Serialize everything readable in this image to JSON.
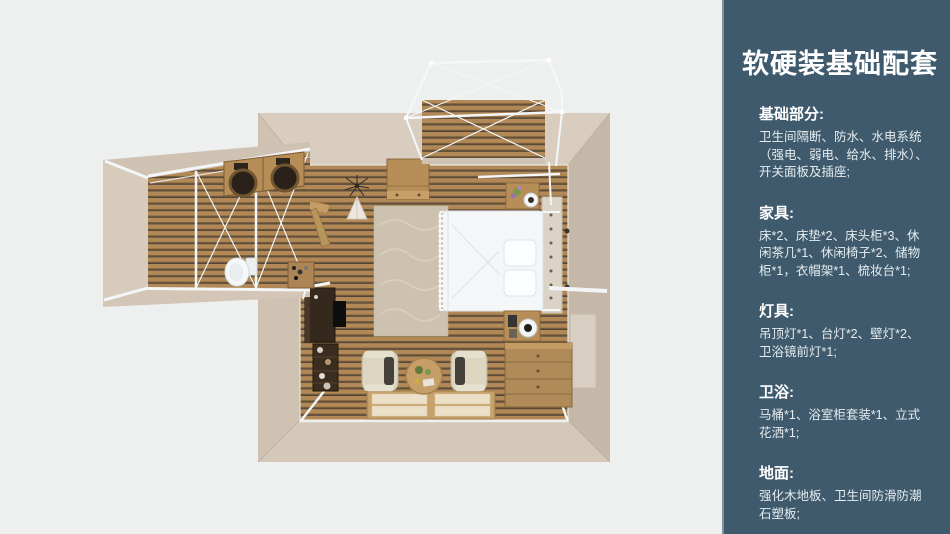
{
  "panel": {
    "title": "软硬装基础配套",
    "sections": [
      {
        "heading": "基础部分:",
        "body": "卫生间隔断、防水、水电系统\n（强电、弱电、给水、排水）、\n开关面板及插座;"
      },
      {
        "heading": "家具:",
        "body": "床*2、床垫*2、床头柜*3、休\n闲茶几*1、休闲椅子*2、储物\n柜*1，衣帽架*1、梳妆台*1;"
      },
      {
        "heading": "灯具:",
        "body": "吊顶灯*1、台灯*2、壁灯*2、\n卫浴镜前灯*1;"
      },
      {
        "heading": "卫浴:",
        "body": "马桶*1、浴室柜套装*1、立式\n花洒*1;"
      },
      {
        "heading": "地面:",
        "body": "强化木地板、卫生间防滑防潮\n石塑板;"
      }
    ]
  },
  "colors": {
    "canvas_bg": "#eef0ef",
    "sidebar_bg": "#3e5a6c",
    "sidebar_edge": "#7e929e",
    "heading_text": "#ffffff",
    "body_text": "#e6ecef",
    "wall_top": "#d9cdbf",
    "wall_left": "#cfc2b3",
    "wall_right": "#c5b8a9",
    "wall_bottom": "#d4c8ba",
    "wood_base": "#b28956",
    "wood_groove": "#6e5534",
    "wood_shadow": "#4e443c",
    "frame_white": "#f3f5f6",
    "bed_white": "#f4f6f8",
    "furniture_wood": "#b78e58",
    "rug": "#ccc2af",
    "mat_frame": "#c6a26a",
    "mat_panel": "#ebdfc8",
    "dark_furniture": "#35291e"
  }
}
